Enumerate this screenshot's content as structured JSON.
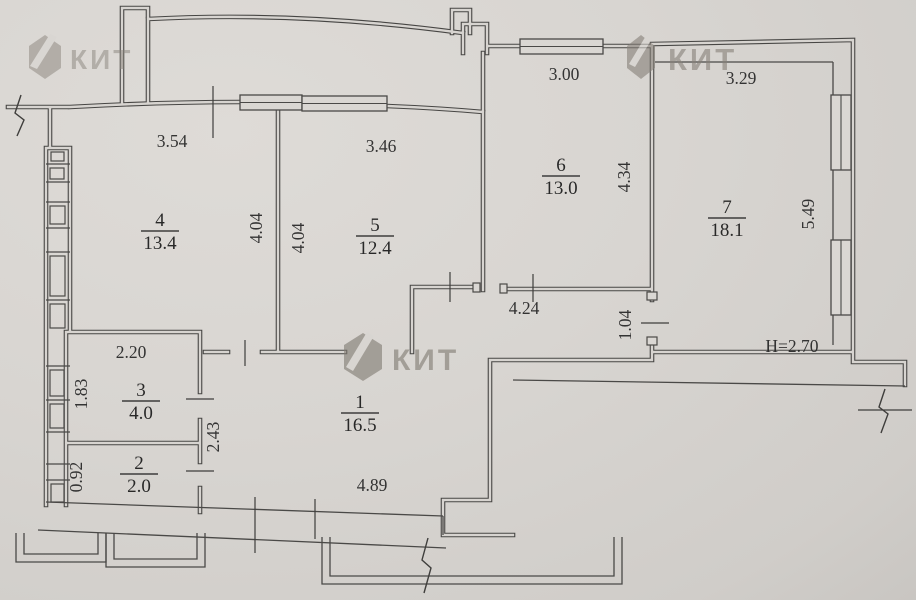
{
  "branding": {
    "logo_text": "КИТ"
  },
  "rooms": [
    {
      "number": "1",
      "area": "16.5"
    },
    {
      "number": "2",
      "area": "2.0"
    },
    {
      "number": "3",
      "area": "4.0"
    },
    {
      "number": "4",
      "area": "13.4"
    },
    {
      "number": "5",
      "area": "12.4"
    },
    {
      "number": "6",
      "area": "13.0"
    },
    {
      "number": "7",
      "area": "18.1"
    }
  ],
  "dimensions": {
    "room4_width": "3.54",
    "room5_width": "3.46",
    "room6_width": "3.00",
    "room7_width": "3.29",
    "room4_depth": "4.04",
    "room5_depth": "4.04",
    "room6_depth": "4.34",
    "room7_depth": "5.49",
    "hall_top_width": "4.24",
    "room7_door_width": "1.04",
    "room3_width": "2.20",
    "room3_depth": "1.83",
    "room2_depth": "0.92",
    "hall_left_depth": "2.43",
    "hall_bottom_width": "4.89",
    "ceiling_height": "H=2.70"
  }
}
